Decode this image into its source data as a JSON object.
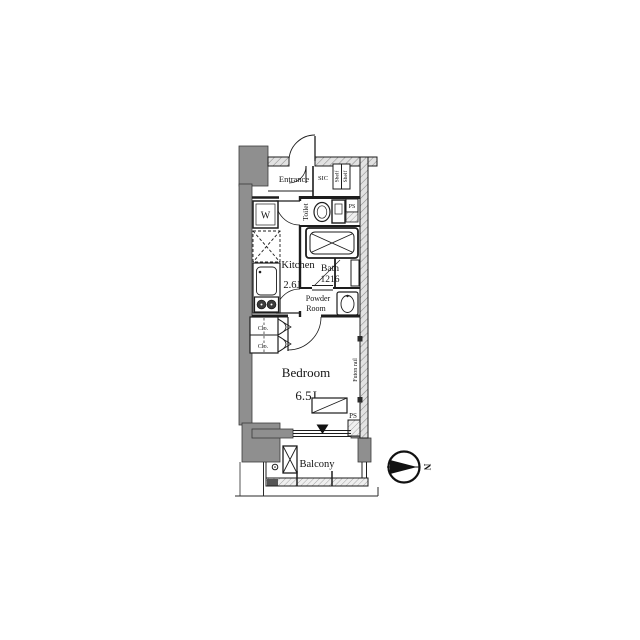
{
  "floorplan": {
    "entrance": {
      "label": "Entrance"
    },
    "sic": {
      "label": "SIC",
      "shelf_top": "Shelf",
      "shelf_bottom": "Shelf",
      "ps": "PS"
    },
    "toilet": {
      "label": "Toilet"
    },
    "bath": {
      "label": "Bath",
      "size": "1216"
    },
    "powder_room": {
      "label_line1": "Powder",
      "label_line2": "Room"
    },
    "kitchen": {
      "label": "Kitchen",
      "size": "2.6J"
    },
    "washer": {
      "label": "W"
    },
    "closet": {
      "top": "Clo.",
      "bottom": "Clo."
    },
    "bedroom": {
      "label": "Bedroom",
      "size": "6.5J"
    },
    "futon_rail": {
      "label": "Futon rail"
    },
    "pipe_space": {
      "label": "PS"
    },
    "balcony": {
      "label": "Balcony"
    },
    "compass": {
      "north": "N"
    },
    "colors": {
      "wall_gray": "#8f8f8f",
      "line": "#1d1d1d"
    }
  }
}
